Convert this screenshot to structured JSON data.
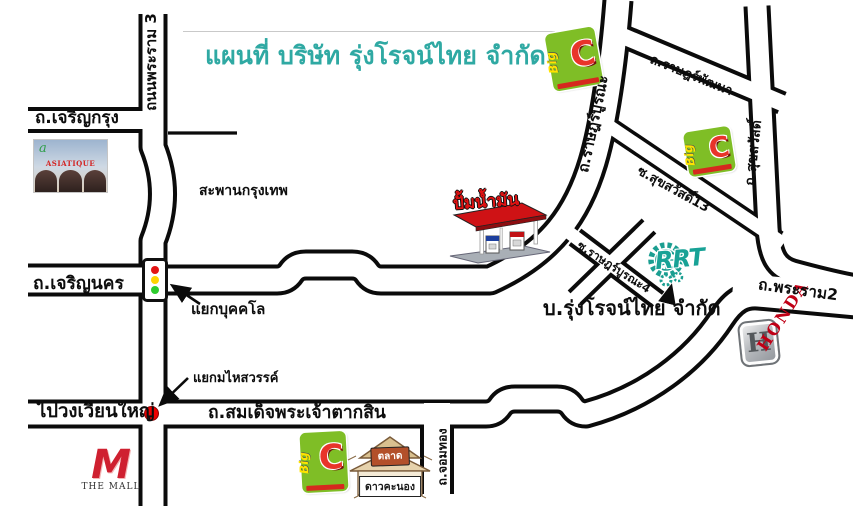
{
  "title": {
    "text": "แผนที่ บริษัท รุ่งโรจน์ไทย จำกัด",
    "color": "#2FA9A3"
  },
  "roads": {
    "rama3": "ถนนพระราม 3",
    "charoen_krung": "ถ.เจริญกรุง",
    "krungthep_bridge": "สะพานกรุงเทพ",
    "charoen_nakhon": "ถ.เจริญนคร",
    "bukkhalo_junction": "แยกบุคคโล",
    "maihasawan_junction": "แยกมไหสวรรค์",
    "to_wongwian_yai": "ไปวงเวียนใหญ่",
    "taksin": "ถ.สมเด็จพระเจ้าตากสิน",
    "chom_thong": "ถ.จอมทอง",
    "rat_burana": "ถ.ราษฎร์บูรณะ",
    "rat_pattana": "ถ.ราษฎร์พัฒนา",
    "soi_suksawat13": "ซ.สุขสวัสดิ์13",
    "suksawat": "ถ.สุขสวัสดิ์",
    "soi_rat_burana4": "ซ.ราษฎร์บูรณะ4",
    "rama2": "ถ.พระราม2"
  },
  "company": {
    "label": "บ.รุ่งโรจน์ไทย จำกัด",
    "logo_text": "RRT",
    "logo_color": "#18A296"
  },
  "landmarks": {
    "gas_station": {
      "label": "ปั้มน้ำมัน"
    },
    "bigc": {
      "small": "Big",
      "letter": "C"
    },
    "honda": {
      "letter": "H",
      "word": "HONDA",
      "red": "#C00016"
    },
    "the_mall": {
      "letter": "M",
      "word": "THE MALL"
    },
    "asiatique": {
      "word": "ASIATIQUE"
    },
    "market": {
      "line1": "ตลาด",
      "line2": "ดาวคะนอง"
    }
  }
}
